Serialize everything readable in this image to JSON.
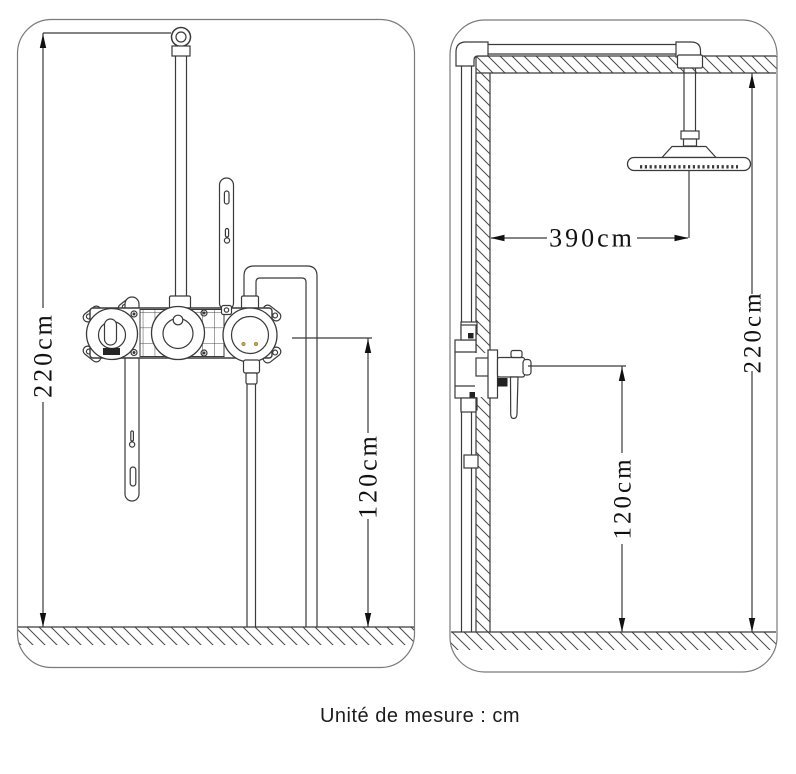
{
  "front_view": {
    "total_height": "220cm",
    "outlet_height": "120cm"
  },
  "side_view": {
    "head_wall_distance": "390cm",
    "total_height": "220cm",
    "valve_height": "120cm"
  },
  "caption": "Unité de mesure : cm",
  "colors": {
    "line": "#3a3a3a",
    "panel_border": "#7a7a7a",
    "text": "#111111",
    "background": "#ffffff",
    "accent_dots": "#c9a43a"
  }
}
